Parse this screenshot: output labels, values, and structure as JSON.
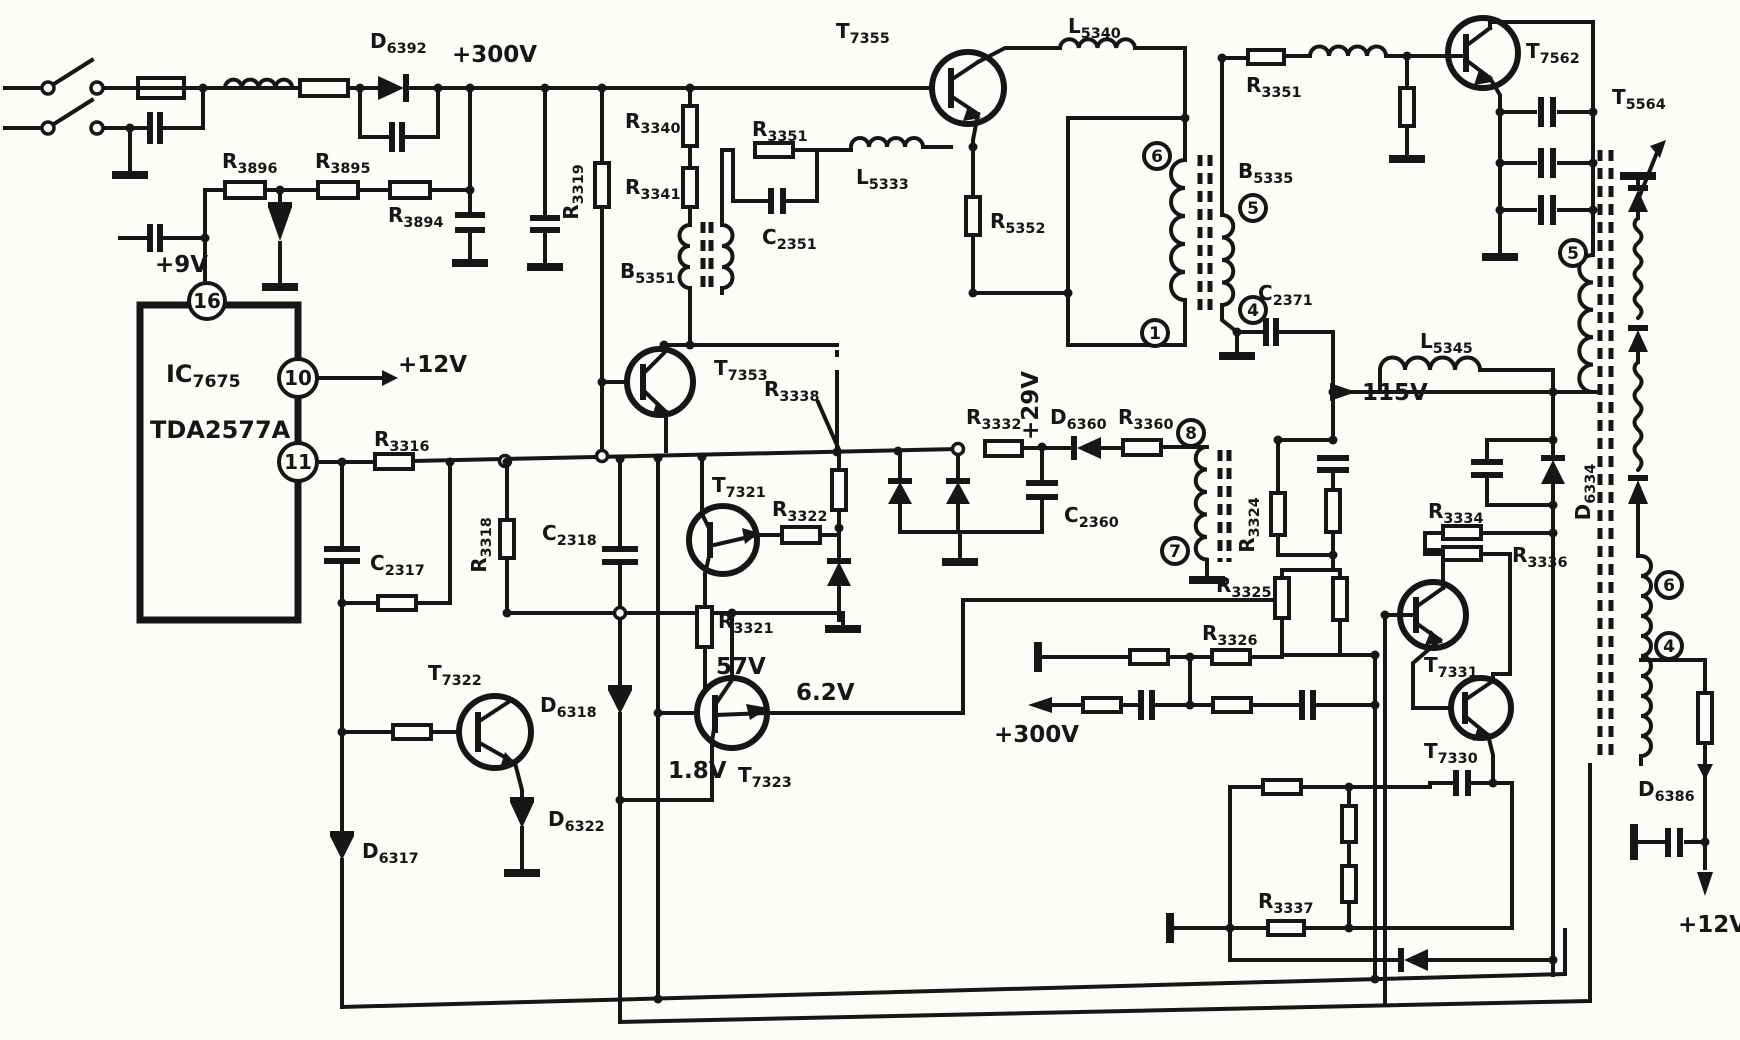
{
  "colors": {
    "ink": "#161616",
    "paper": "#fcfcf8"
  },
  "labels": {
    "v300_top": "+300V",
    "d6392": "D|6392",
    "r3896": "R|3896",
    "r3895": "R|3895",
    "r3894": "R|3894",
    "v9": "+9V",
    "ic_ref": "IC|7675",
    "ic_part": "TDA2577A",
    "pin16": "16",
    "pin10": "10",
    "pin11": "11",
    "v12_ic": "+12V",
    "r3319": "R|3319",
    "r3340": "R|3340",
    "r3341": "R|3341",
    "b5351": "B|5351",
    "r3351_left": "R|3351",
    "c2351": "C|2351",
    "l5333": "L|5333",
    "t7353": "T|7353",
    "t7355": "T|7355",
    "r5352": "R|5352",
    "l5340": "L|5340",
    "r3351_right": "R|3351",
    "b5335": "B|5335",
    "t7562": "T|7562",
    "t5564": "T|5564",
    "c2371": "C|2371",
    "v115": "115V",
    "l5345": "L|5345",
    "d6334": "D|6334",
    "w6": "6",
    "w5": "5",
    "w1": "1",
    "w4": "4",
    "w8": "8",
    "w7": "7",
    "f5": "5",
    "f6": "6",
    "f4": "4",
    "r3316": "R|3316",
    "c2317": "C|2317",
    "r3318": "R|3318",
    "c2318": "C|2318",
    "t7322": "T|7322",
    "d6317": "D|6317",
    "d6322": "D|6322",
    "d6318": "D|6318",
    "t7321": "T|7321",
    "r3322": "R|3322",
    "r3321": "R|3321",
    "v57": "57V",
    "v1_8": "1.8V",
    "t7323": "T|7323",
    "v6_2": "6.2V",
    "r3338": "R|3338",
    "r3332": "R|3332",
    "v29": "+29V",
    "d6360": "D|6360",
    "r3360": "R|3360",
    "c2360": "C|2360",
    "r3324": "R|3324",
    "r3325": "R|3325",
    "r3326": "R|3326",
    "v300_mid": "+300V",
    "r3334": "R|3334",
    "r3336": "R|3336",
    "t7331": "T|7331",
    "t7330": "T|7330",
    "r3337": "R|3337",
    "d6386": "D|6386",
    "v12_out": "+12V"
  }
}
